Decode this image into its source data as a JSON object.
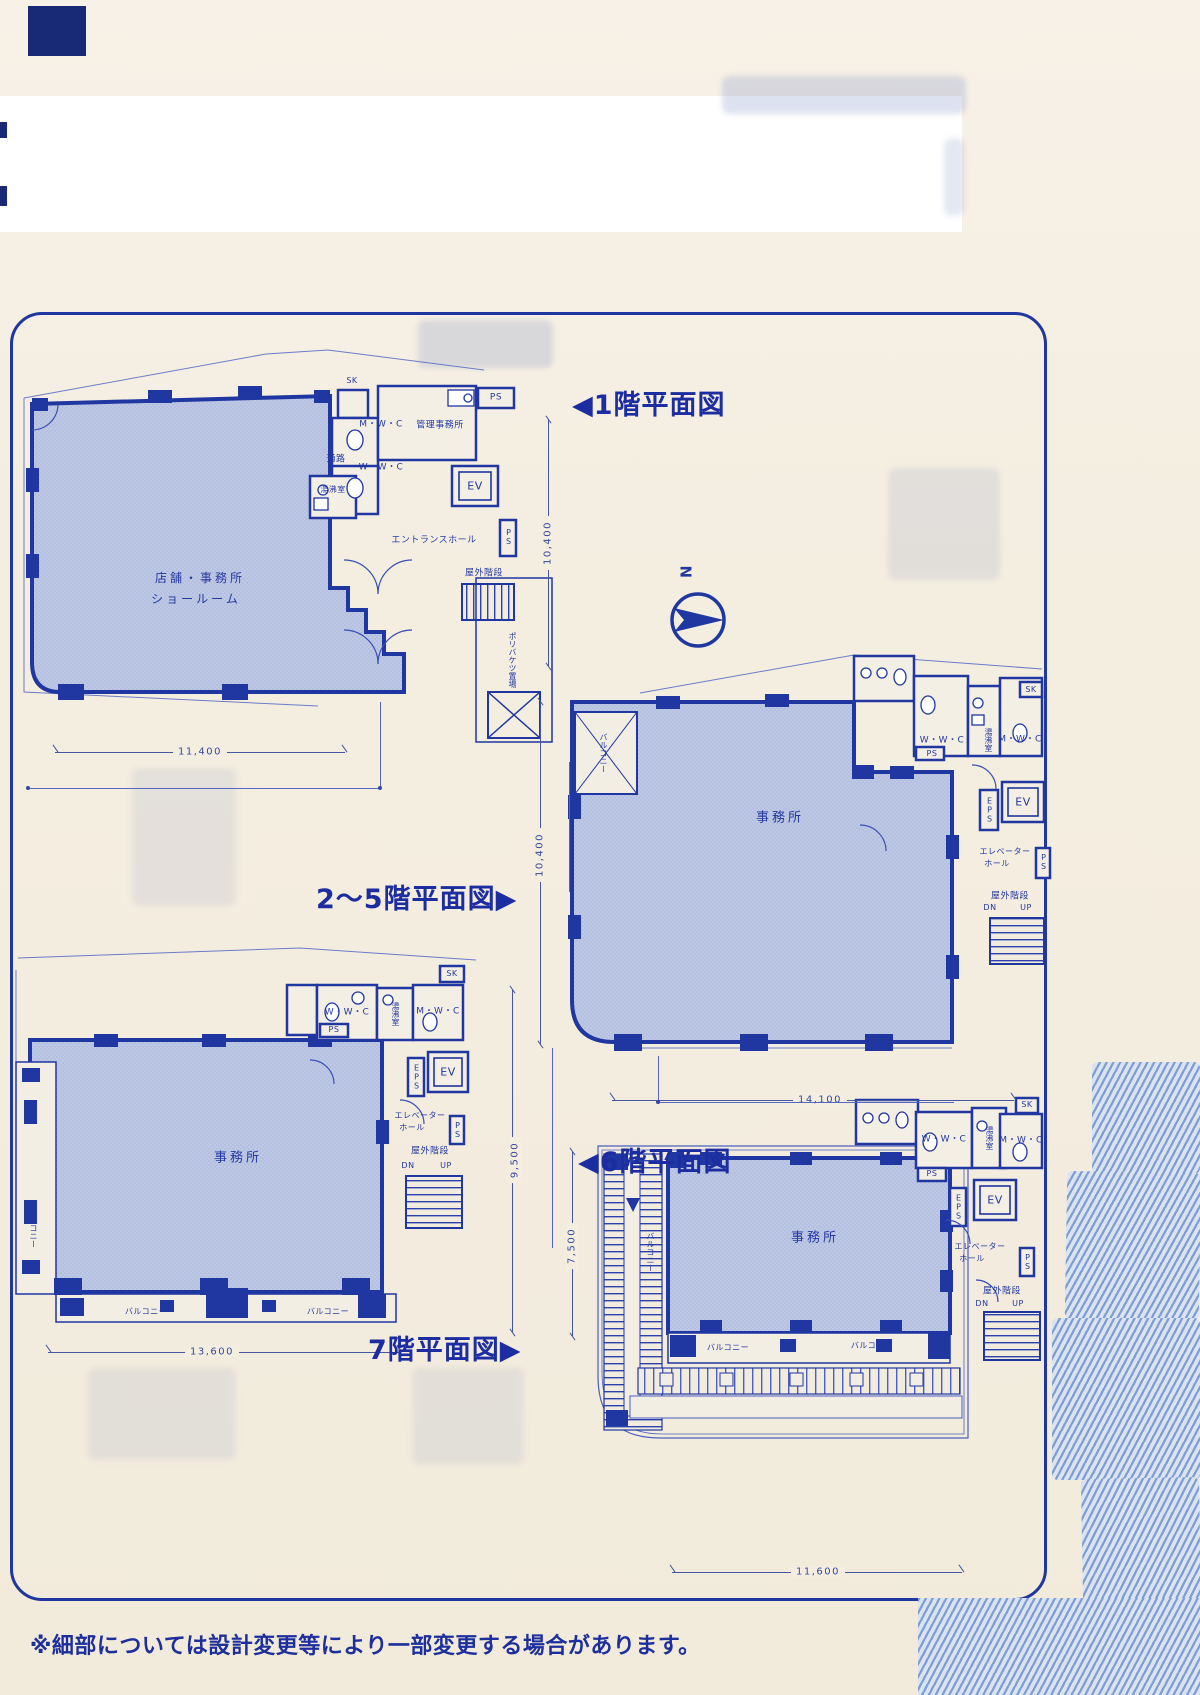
{
  "titles": {
    "f1": "◀1階平面図",
    "f25": "2〜5階平面図▶",
    "f6": "◀6階平面図",
    "f7": "7階平面図▶"
  },
  "north_label": "N",
  "footnote": "※細部については設計変更等により一部変更する場合があります。",
  "labels": {
    "wwc": "W・W・C",
    "mwc": "M・W・C",
    "ps": "PS",
    "sk": "SK",
    "eps": "EPS",
    "ev": "EV",
    "yuwakashi": "湯沸室",
    "kanri": "管理事務所",
    "tsuro": "通路",
    "entrance": "エントランスホール",
    "shop1": "店舗・事務所",
    "shop2": "ショールーム",
    "office": "事務所",
    "balcony": "バルコニー",
    "elv1": "エレベーター",
    "elv2": "ホール",
    "stairs": "屋外階段",
    "dn": "DN",
    "up": "UP",
    "bucket": "ポリバケツ置場"
  },
  "dimensions": {
    "f1_w": "11,400",
    "f1_h": "10,400",
    "f25_h": "10,400",
    "f25_w": "14,100",
    "f6_w": "13,600",
    "f6_h": "9,500",
    "f7_h": "7,500",
    "f7_w": "11,600"
  }
}
